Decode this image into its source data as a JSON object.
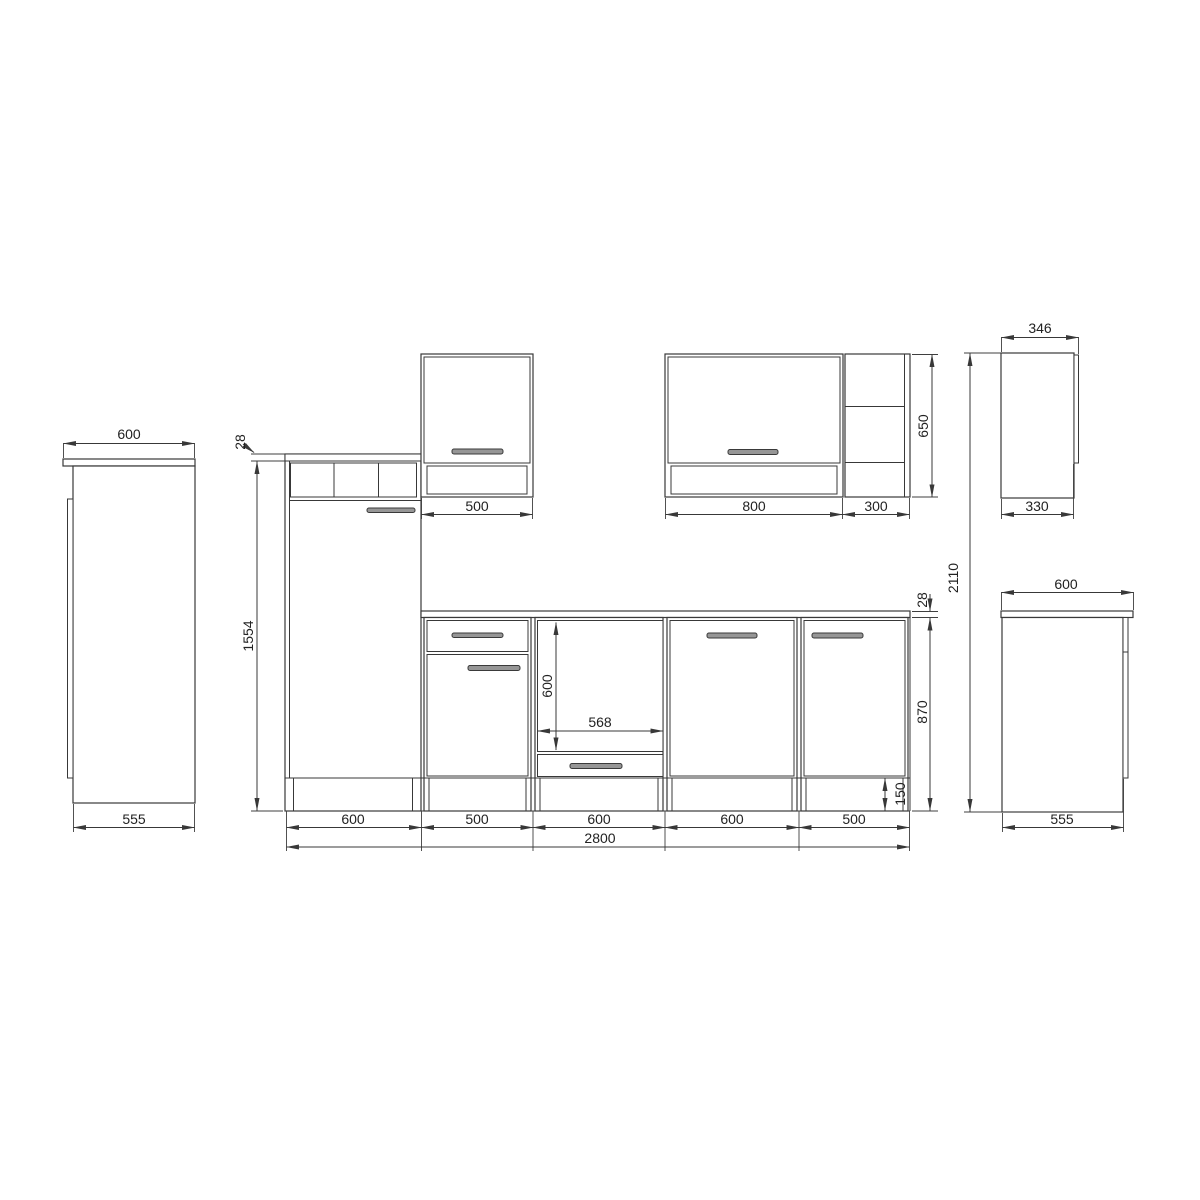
{
  "drawing_title": "Kitchen unit dimension drawing",
  "colors": {
    "line": "#383838",
    "text": "#222222",
    "handle_fill": "#969696",
    "background": "#ffffff"
  },
  "views": {
    "tall_cabinet_side": {
      "top_width": "600",
      "body_depth": "555"
    },
    "front_elevation": {
      "top_panel_thickness": "28",
      "tall_cabinet_height": "1554",
      "wall_cabinet_width": "500",
      "hood_cabinet_width": "800",
      "open_shelf_width": "300",
      "wall_cabinet_height": "650",
      "oven_niche_height": "600",
      "oven_niche_width": "568",
      "worktop_thickness": "28",
      "base_height": "870",
      "plinth_height": "150",
      "base_unit_widths": [
        "600",
        "500",
        "600",
        "600",
        "500"
      ],
      "total_width": "2800"
    },
    "wall_cabinet_side": {
      "top_depth": "346",
      "body_depth": "330"
    },
    "base_cabinet_side": {
      "top_width": "600",
      "body_depth": "555"
    },
    "total_height": "2110"
  }
}
